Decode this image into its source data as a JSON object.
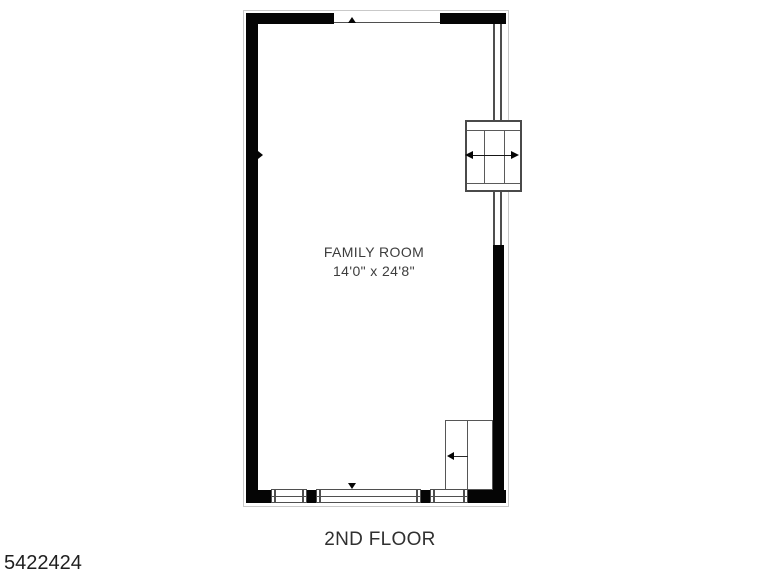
{
  "page": {
    "background_color": "#ffffff"
  },
  "plan": {
    "room": {
      "name": "FAMILY ROOM",
      "dimensions": "14'0\" x 24'8\""
    },
    "floor_label": "2ND FLOOR",
    "listing_number": "5422424",
    "colors": {
      "wall": "#050505",
      "feature_line": "#4f4f4f",
      "outline": "#c9c9c9",
      "label_text": "#3d3d3d"
    },
    "icons": {
      "bay_arrow": "double-headed horizontal arrow (black triangles)",
      "closet_arrow": "left-pointing arrow",
      "opening_marker_top": "small up triangle",
      "opening_marker_bottom": "small down triangle",
      "wall_tick_left": "small right triangle"
    }
  }
}
